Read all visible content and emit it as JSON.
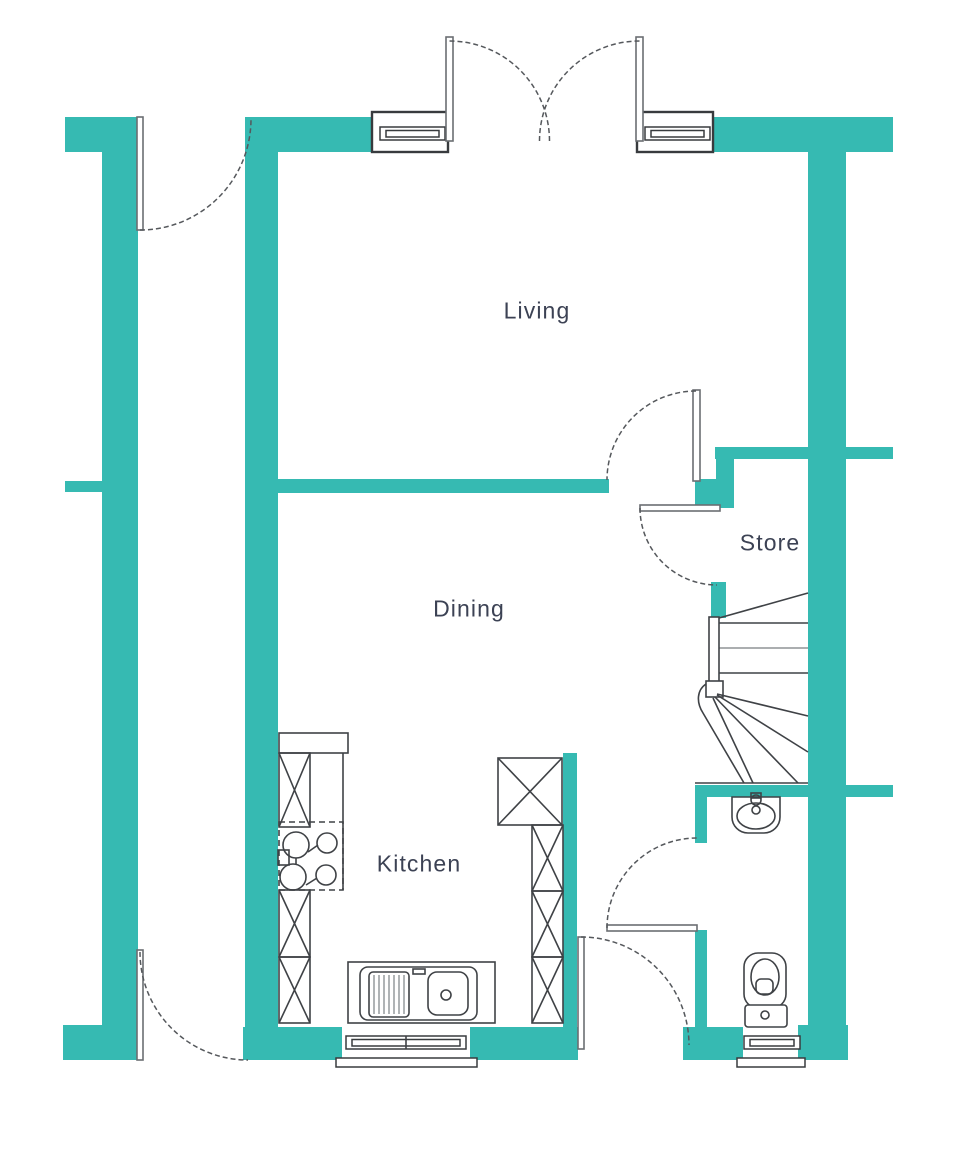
{
  "colors": {
    "wall": "#36BAB2",
    "line": "#3F4246",
    "line2": "#8F9396",
    "label": "#3C4254",
    "bg": "#FFFFFF"
  },
  "rooms": {
    "living": {
      "label": "Living"
    },
    "dining": {
      "label": "Dining"
    },
    "kitchen": {
      "label": "Kitchen"
    },
    "store": {
      "label": "Store"
    }
  },
  "fixtures": {
    "staircase": "winder-staircase",
    "toilet": "toilet",
    "basin": "wash-basin",
    "hob": "four-burner-hob",
    "sink": "double-sink-with-drainer",
    "french_doors": "double-french-doors",
    "windows": "window"
  }
}
